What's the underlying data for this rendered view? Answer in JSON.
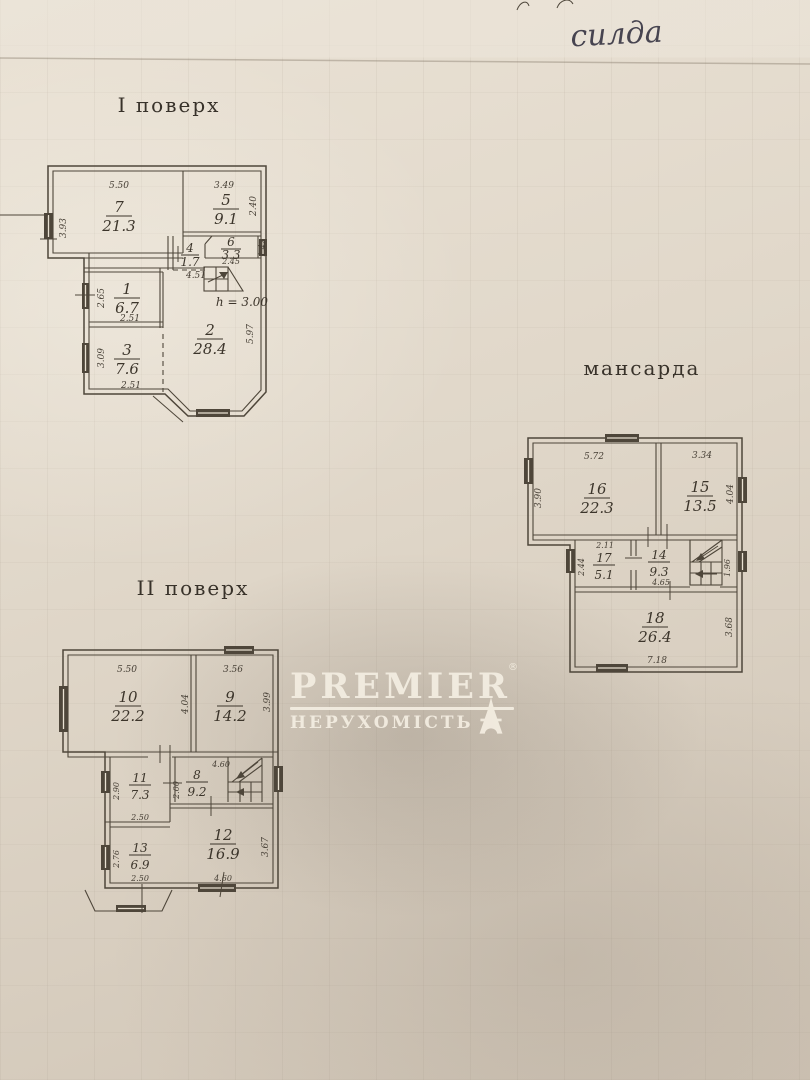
{
  "annotations": {
    "handwriting": "силда"
  },
  "watermark": {
    "brand": "PREMIER",
    "registered": "®",
    "subtitle": "НЕРУХОМІСТЬ"
  },
  "colors": {
    "paper": "#ddd3c5",
    "ink": "#4e463a",
    "watermark": "#f4eee2"
  },
  "floor1": {
    "title": "I поверх",
    "note": "h = 3.00",
    "rooms": {
      "r7": {
        "num": "7",
        "area": "21.3"
      },
      "r5": {
        "num": "5",
        "area": "9.1"
      },
      "r4": {
        "num": "4",
        "area": "1.7"
      },
      "r6": {
        "num": "6",
        "area": "3.3"
      },
      "r1": {
        "num": "1",
        "area": "6.7"
      },
      "r2": {
        "num": "2",
        "area": "28.4"
      },
      "r3": {
        "num": "3",
        "area": "7.6"
      }
    },
    "dims": {
      "w7": "5.50",
      "h7": "3.93",
      "w5": "3.49",
      "h5": "2.40",
      "w6": "2.45",
      "h6": "1.42",
      "w4": "4.51",
      "h1": "2.65",
      "w1": "2.51",
      "h3": "3.09",
      "w3": "2.51",
      "h2": "5.97"
    }
  },
  "mansard": {
    "title": "мансарда",
    "rooms": {
      "r16": {
        "num": "16",
        "area": "22.3"
      },
      "r15": {
        "num": "15",
        "area": "13.5"
      },
      "r17": {
        "num": "17",
        "area": "5.1"
      },
      "r14": {
        "num": "14",
        "area": "9.3"
      },
      "r18": {
        "num": "18",
        "area": "26.4"
      }
    },
    "dims": {
      "w16": "5.72",
      "h16": "3.90",
      "w15": "3.34",
      "h15": "4.04",
      "w17": "2.11",
      "h17": "2.44",
      "w14": "4.65",
      "hs": "1.96",
      "h18": "3.68",
      "w18": "7.18"
    }
  },
  "floor2": {
    "title": "II поверх",
    "rooms": {
      "r10": {
        "num": "10",
        "area": "22.2"
      },
      "r9": {
        "num": "9",
        "area": "14.2"
      },
      "r11": {
        "num": "11",
        "area": "7.3"
      },
      "r8": {
        "num": "8",
        "area": "9.2"
      },
      "r13": {
        "num": "13",
        "area": "6.9"
      },
      "r12": {
        "num": "12",
        "area": "16.9"
      }
    },
    "dims": {
      "w10": "5.50",
      "h10": "4.04",
      "w9": "3.56",
      "h9": "3.99",
      "h11": "2.90",
      "w11": "2.50",
      "w8": "4.60",
      "h8": "2.00",
      "h13": "2.76",
      "w13": "2.50",
      "h12": "3.67",
      "w12": "4.60"
    }
  }
}
